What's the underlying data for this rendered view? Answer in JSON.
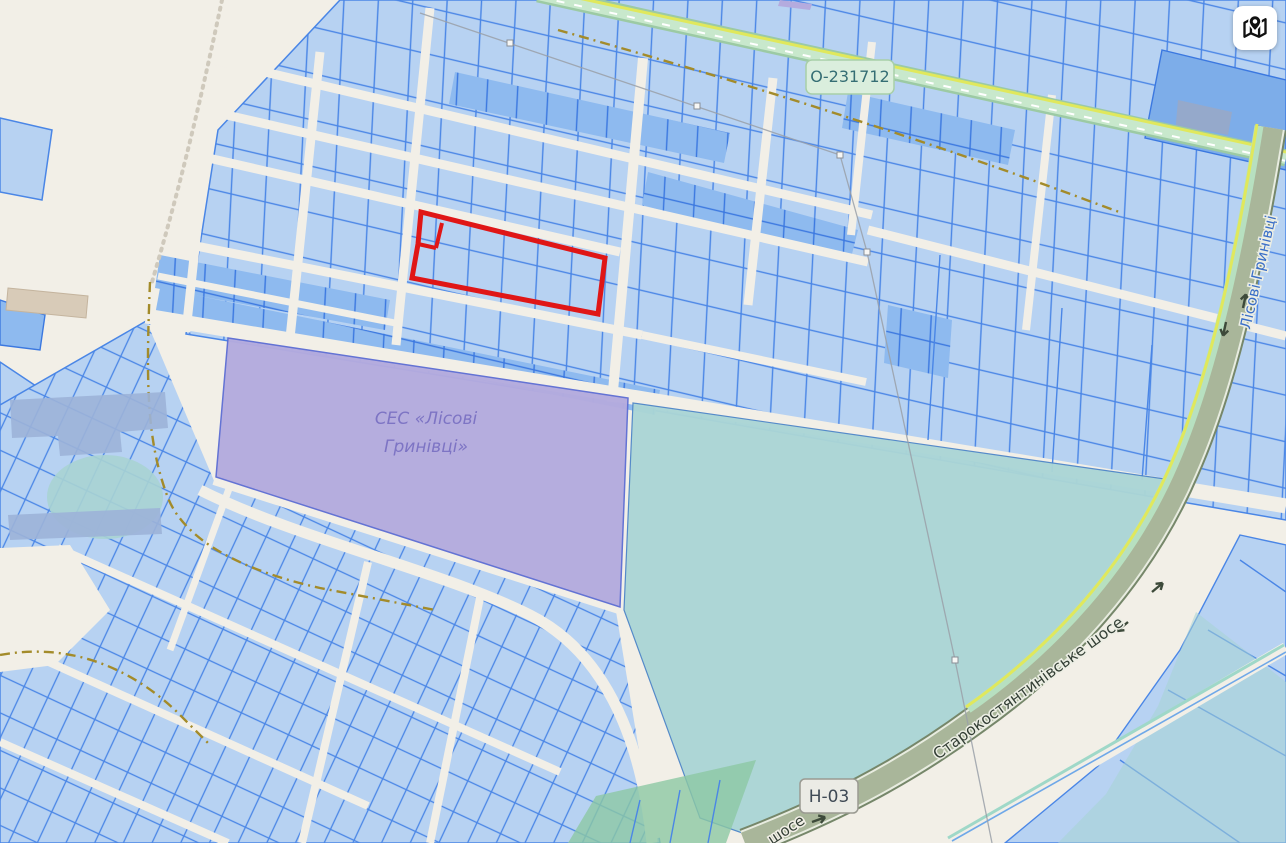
{
  "map": {
    "description": "cadastral parcel map viewer",
    "labels": {
      "road_top": "О-231712",
      "road_national": "Н-03",
      "street_right": "Лісові Гринівці",
      "highway": "Старокостянтинівське шосе",
      "highway_partial": "шосе",
      "area_line1": "СЕС «Лісові",
      "area_line2": "Гринівці»"
    },
    "colors": {
      "background": "#f2efe7",
      "parcel_fill": "#b7d2f2",
      "parcel_fill_dark": "#8ebaef",
      "parcel_stroke": "#4a86e6",
      "selected_outline": "#e01616",
      "ses_area_fill": "#b4abde",
      "ses_text": "#7d74c4",
      "field_teal": "#abd6d6",
      "road_green_stripe": "#b7e0c0",
      "road_yellow_line": "#e0e85c",
      "highway_fill": "#a9b69a",
      "badge_green_bg": "#daeedd",
      "badge_gray_bg": "#ebebe5",
      "street_name_blue": "#3a6fc8"
    },
    "controls": {
      "map_button_icon": "map-with-pin-icon"
    }
  }
}
